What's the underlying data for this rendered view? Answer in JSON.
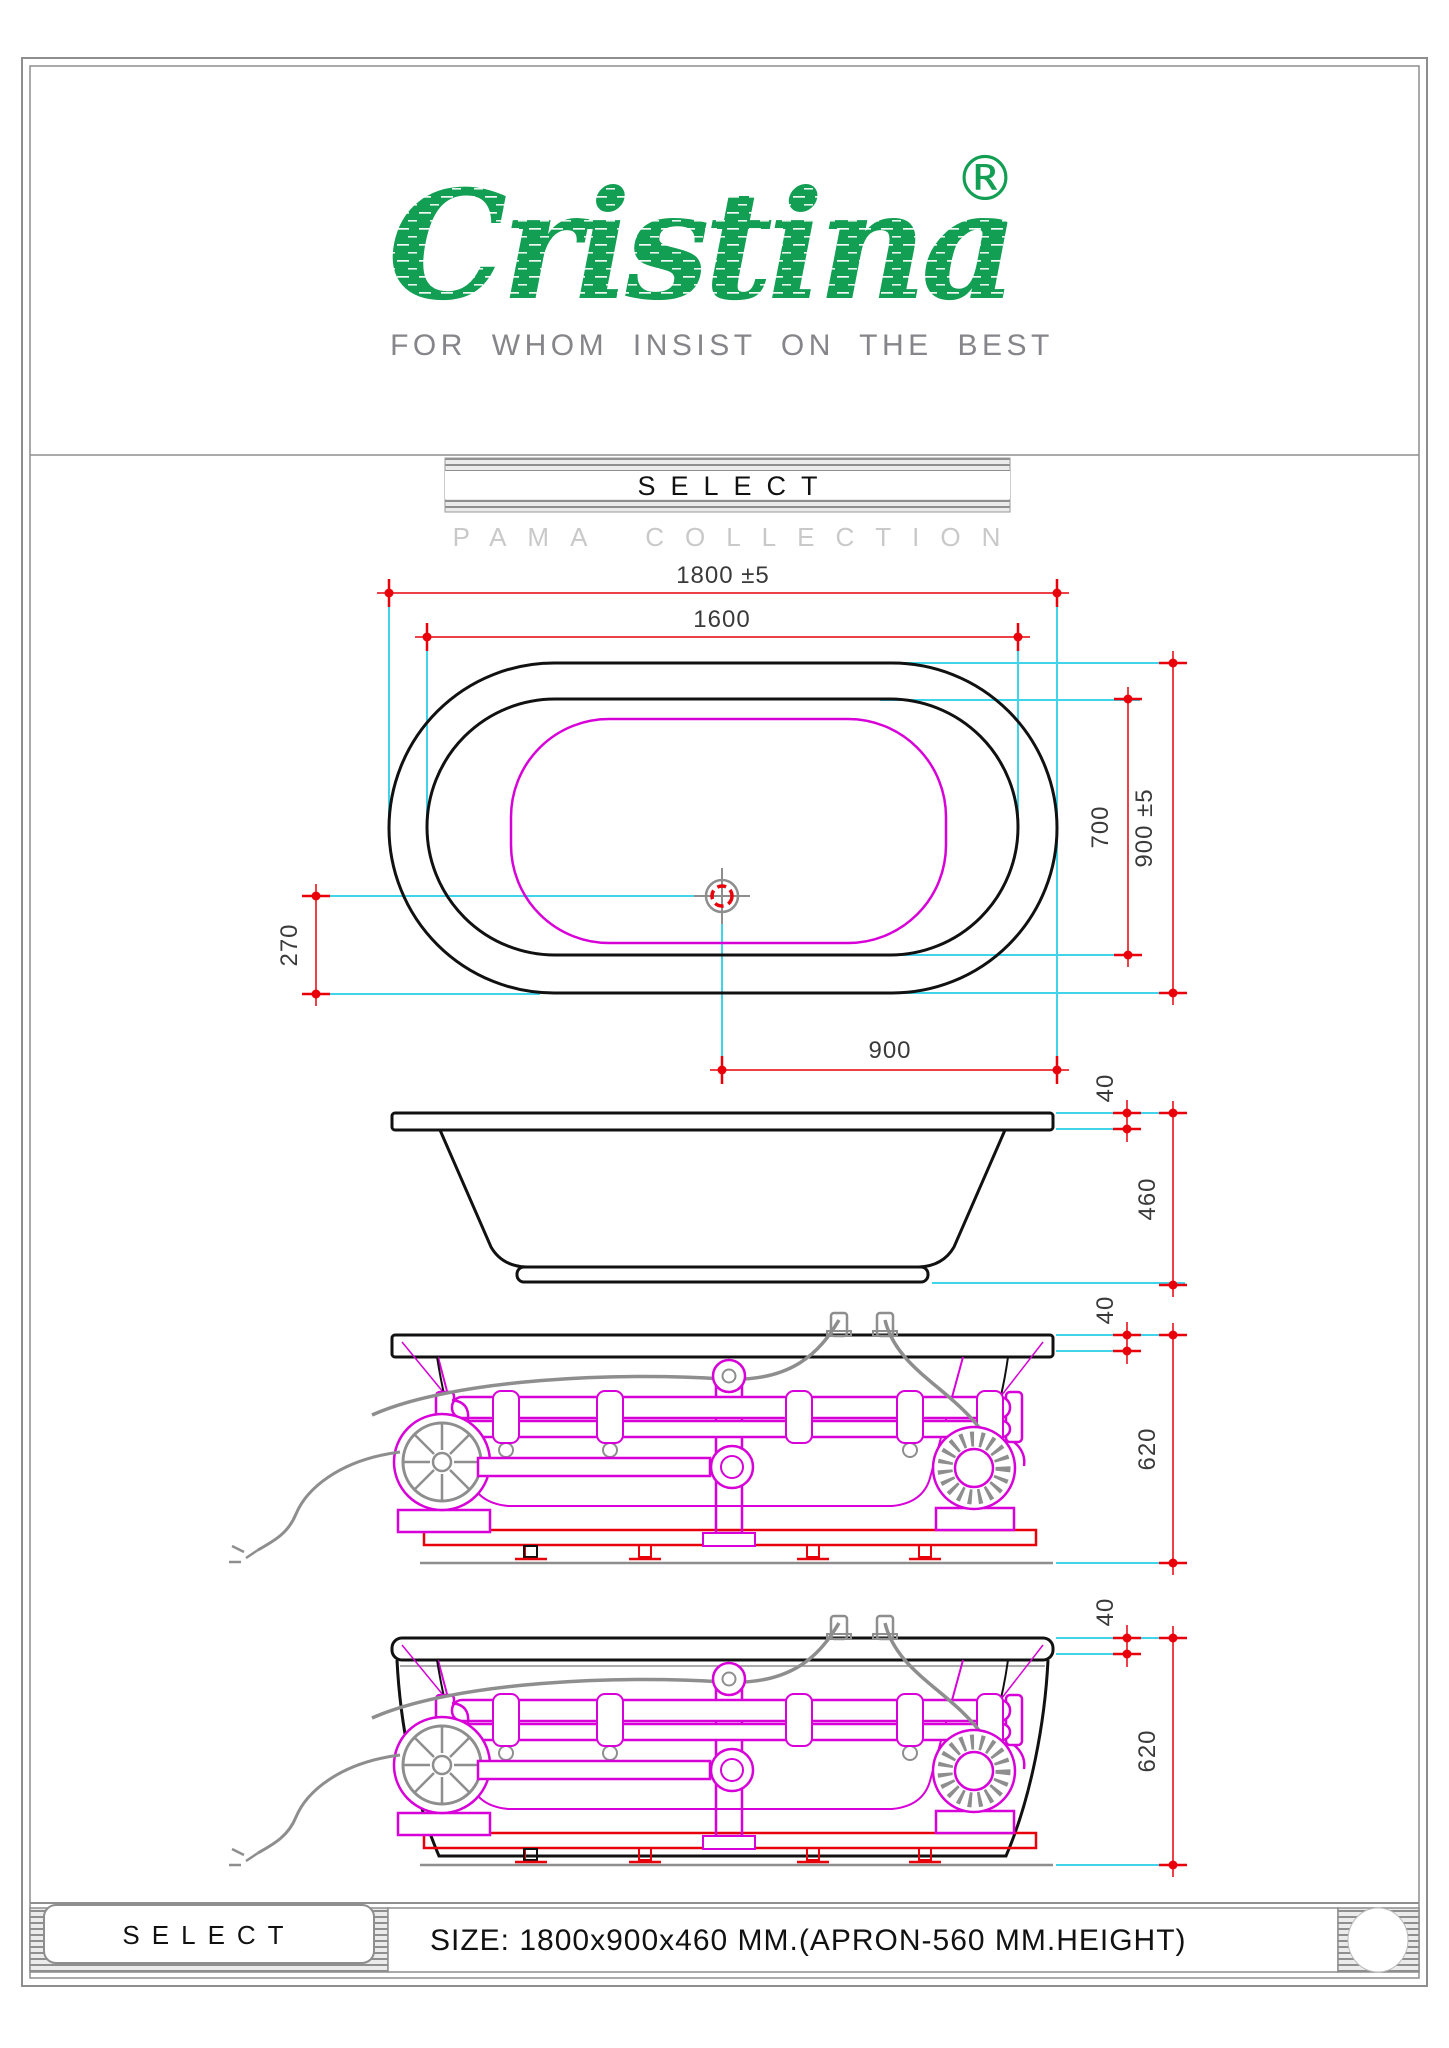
{
  "brand": {
    "name": "Cristina",
    "registered": "®",
    "tagline": "FOR WHOM INSIST ON THE BEST",
    "brand_color": "#129e53",
    "tagline_color": "#85858a"
  },
  "header": {
    "model": "SELECT",
    "collection": "PAMA COLLECTION"
  },
  "dims": {
    "top": {
      "overall_length": "1800 ±5",
      "rim_length": "1600",
      "overall_width": "900 ±5",
      "basin_width": "700",
      "drain_offset": "270",
      "drain_position": "900"
    },
    "side": {
      "rim_height": "40",
      "body_height": "460"
    },
    "system": {
      "rim_height": "40",
      "overall_height": "620"
    },
    "apron": {
      "rim_height": "40",
      "overall_height": "620"
    }
  },
  "footer": {
    "model": "SELECT",
    "size": "SIZE: 1800x900x460 MM.(APRON-560 MM.HEIGHT)"
  },
  "colors": {
    "dimension_red": "#e8000a",
    "extension_cyan": "#3fd4ea",
    "plumbing_magenta": "#d800d8",
    "outline_black": "#111111",
    "hardware_gray": "#8e8e8e"
  }
}
